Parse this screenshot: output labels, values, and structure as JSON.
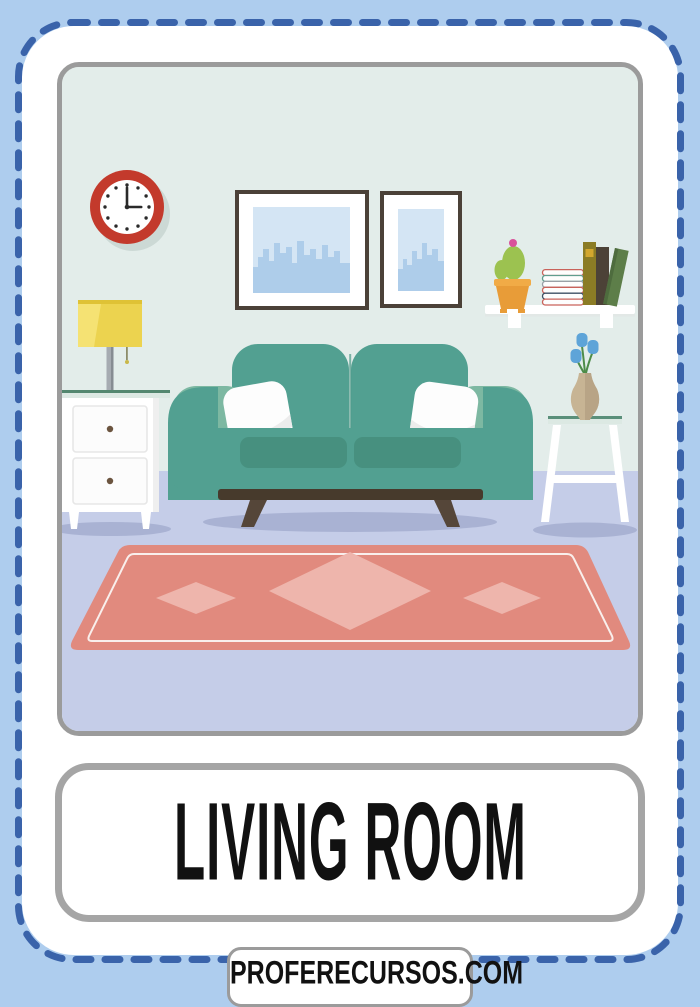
{
  "flashcard": {
    "title": "LIVING ROOM",
    "watermark": "PROFERECURSOS.COM"
  },
  "scene": {
    "description": "flat illustration of a living room",
    "clock_time": "3:00",
    "items": [
      "wall clock",
      "landscape city picture",
      "portrait city picture",
      "wall shelf",
      "potted cactus",
      "stacked books",
      "standing books",
      "table lamp",
      "nightstand with two drawers",
      "teal sofa with two white pillows",
      "stool",
      "vase with blue tulips",
      "pink rug with diamonds"
    ],
    "colors": {
      "background": "#aecdee",
      "dashed_border": "#3a63aa",
      "card": "#ffffff",
      "panel_border": "#9b9b9b",
      "wall": "#e3edea",
      "floor": "#c5cde8",
      "shadow": "#a9b2d3",
      "clock_red": "#c33a2c",
      "frame_brown": "#4b4138",
      "picture_blue": "#d4e5f4",
      "skyline_blue": "#aecdea",
      "sofa_teal": "#52a091",
      "sofa_arm_light": "#7db8a2",
      "seat_cushion": "#47907f",
      "wood_dark": "#473a2c",
      "leg_brown": "#554639",
      "pillow": "#fdfdfd",
      "lamp_yellow": "#ecd34f",
      "pot_orange": "#e89c38",
      "cactus_green": "#9cc250",
      "flower_pink": "#d9519b",
      "tulip_blue": "#5ea4d8",
      "vase_tan": "#c7b494",
      "rug_pink": "#e18a7e",
      "rug_diamond": "#eeb5ac",
      "text": "#111111"
    }
  }
}
